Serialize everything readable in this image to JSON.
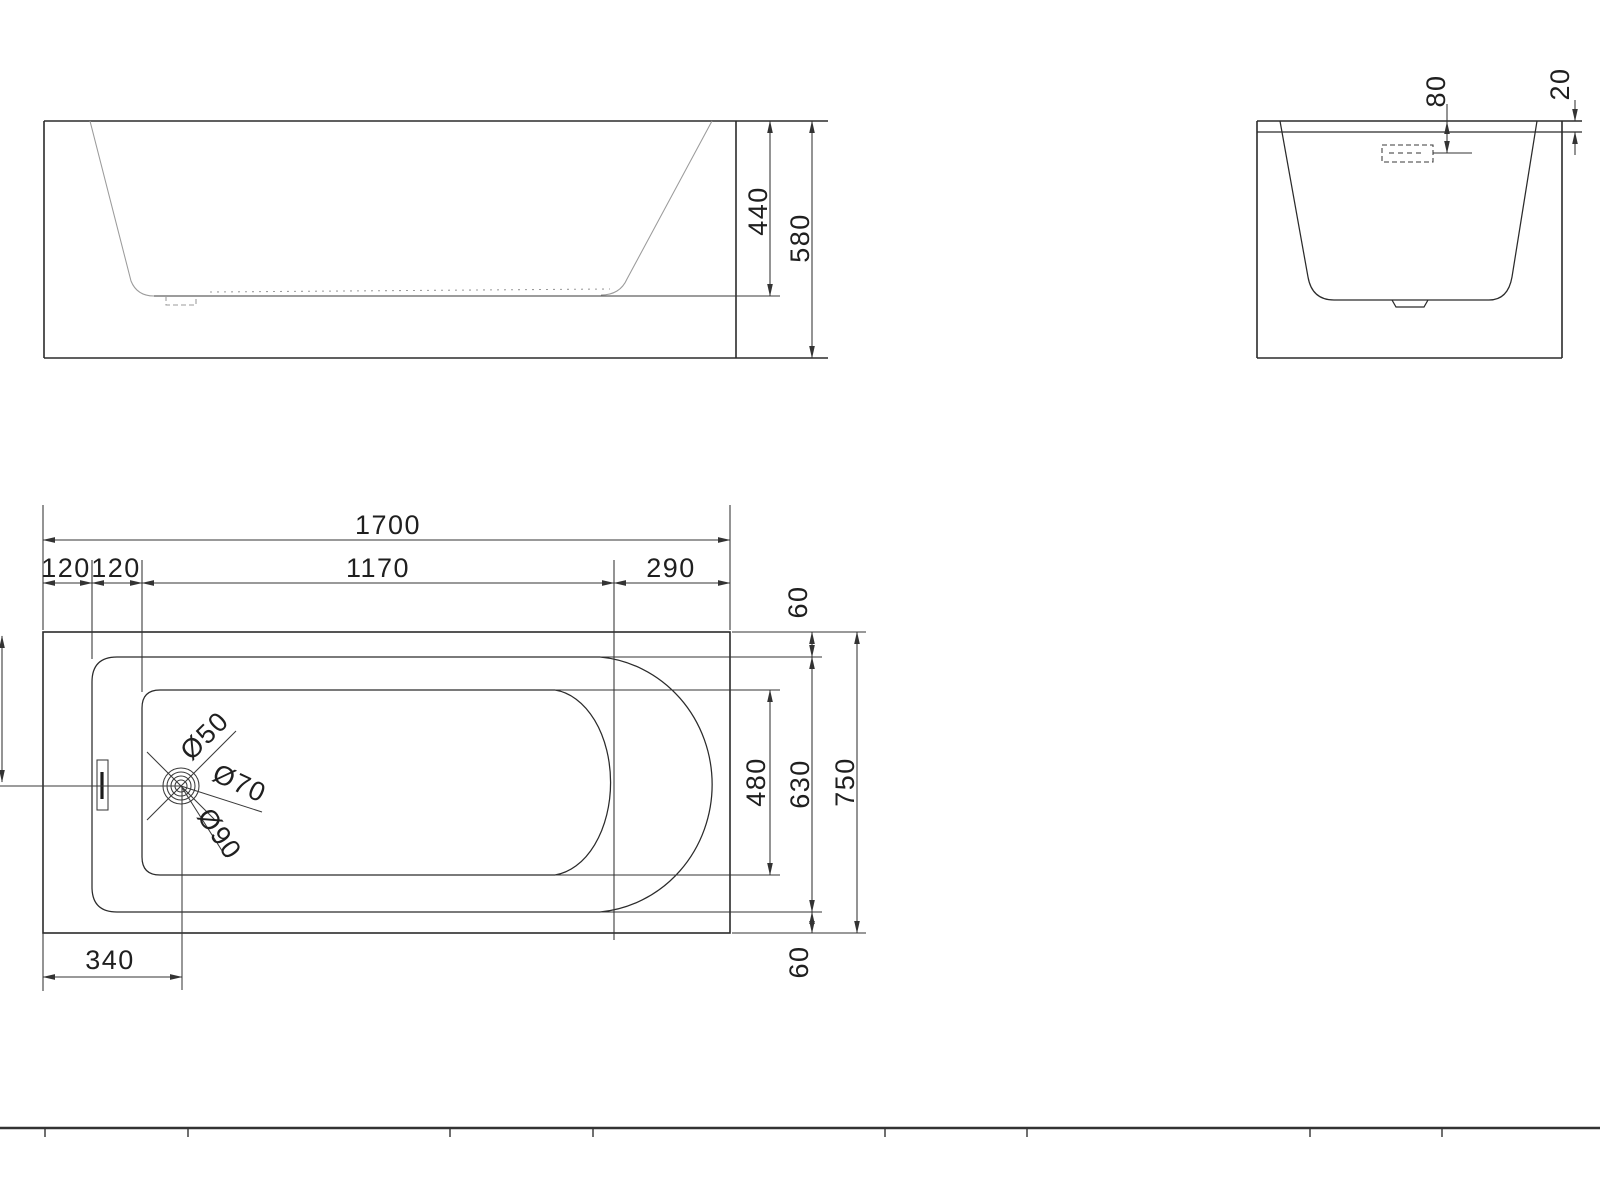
{
  "drawing": {
    "type": "bathtub-technical-drawing",
    "background": "#ffffff",
    "line_color": "#2b2b2b",
    "dim_text_color": "#1f1f1f",
    "views": {
      "side": {
        "name": "side-elevation",
        "dim_inner_depth": "440",
        "dim_overall_height": "580"
      },
      "end": {
        "name": "end-elevation",
        "dim_overflow_drop": "80",
        "dim_rim_thickness": "20"
      },
      "plan": {
        "name": "plan-view",
        "dim_overall_length": "1700",
        "dim_left_offset_1": "120",
        "dim_left_offset_2": "120",
        "dim_floor_length": "1170",
        "dim_end_offset": "290",
        "dim_rim_top": "60",
        "dim_floor_width": "480",
        "dim_inner_width": "630",
        "dim_overall_width": "750",
        "dim_rim_bottom": "60",
        "dim_drain_offset": "340",
        "drain_dia_small": "Ø50",
        "drain_dia_mid": "Ø70",
        "drain_dia_large": "Ø90"
      }
    }
  }
}
